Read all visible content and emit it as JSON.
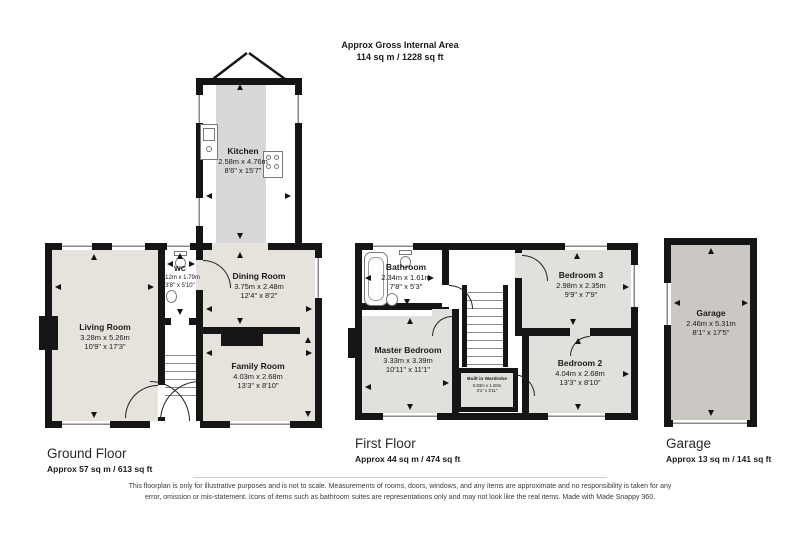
{
  "header": {
    "line1": "Approx Gross Internal Area",
    "line2": "114 sq m / 1228 sq ft"
  },
  "rooms": {
    "kitchen": {
      "name": "Kitchen",
      "metric": "2.58m x 4.76m",
      "imperial": "8'6\" x 15'7\""
    },
    "living": {
      "name": "Living Room",
      "metric": "3.28m x 5.26m",
      "imperial": "10'9\" x 17'3\""
    },
    "wc": {
      "name": "WC",
      "metric": "1.12m x 1.79m",
      "imperial": "3'8\" x 5'10\""
    },
    "dining": {
      "name": "Dining Room",
      "metric": "3.75m x 2.48m",
      "imperial": "12'4\" x 8'2\""
    },
    "family": {
      "name": "Family Room",
      "metric": "4.03m x 2.68m",
      "imperial": "13'3\" x 8'10\""
    },
    "bathroom": {
      "name": "Bathroom",
      "metric": "2.34m x 1.61m",
      "imperial": "7'8\" x 5'3\""
    },
    "bedroom3": {
      "name": "Bedroom 3",
      "metric": "2.98m x 2.35m",
      "imperial": "9'9\" x 7'9\""
    },
    "master": {
      "name": "Master Bedroom",
      "metric": "3.33m x 3.39m",
      "imperial": "10'11\" x 11'1\""
    },
    "wardrobe": {
      "name": "Built in Wardrobe",
      "metric": "0.93m x 1.20m",
      "imperial": "3'1\" x 3'11\""
    },
    "bedroom2": {
      "name": "Bedroom 2",
      "metric": "4.04m x 2.68m",
      "imperial": "13'3\" x 8'10\""
    },
    "garage": {
      "name": "Garage",
      "metric": "2.46m x 5.31m",
      "imperial": "8'1\" x 17'5\""
    }
  },
  "floor_labels": {
    "ground": {
      "title": "Ground Floor",
      "area": "Approx 57 sq m / 613 sq ft"
    },
    "first": {
      "title": "First Floor",
      "area": "Approx 44 sq m / 474 sq ft"
    },
    "garage": {
      "title": "Garage",
      "area": "Approx 13 sq m / 141 sq ft"
    }
  },
  "disclaimer": "This floorplan is only for illustrative purposes and is not to scale. Measurements of rooms, doors, windows, and any items are approximate and no responsibility is taken for any error, omission or mis-statement. Icons of items such as bathroom suites are representations only and may not look like the real items. Made with Made Snappy 360.",
  "colors": {
    "wall": "#151515",
    "room_ground": "#e6e2dc",
    "room_first": "#e2e0dd",
    "kitchen_floor": "#d8d8d8",
    "garage_floor": "#cbc7c3"
  },
  "icons": [
    "toilet-icon",
    "sink-icon",
    "bathtub-icon",
    "hob-icon",
    "kitchen-sink-icon",
    "stairs-icon",
    "door-arc-icon",
    "window-icon",
    "measure-arrow-icon",
    "french-doors-icon"
  ]
}
